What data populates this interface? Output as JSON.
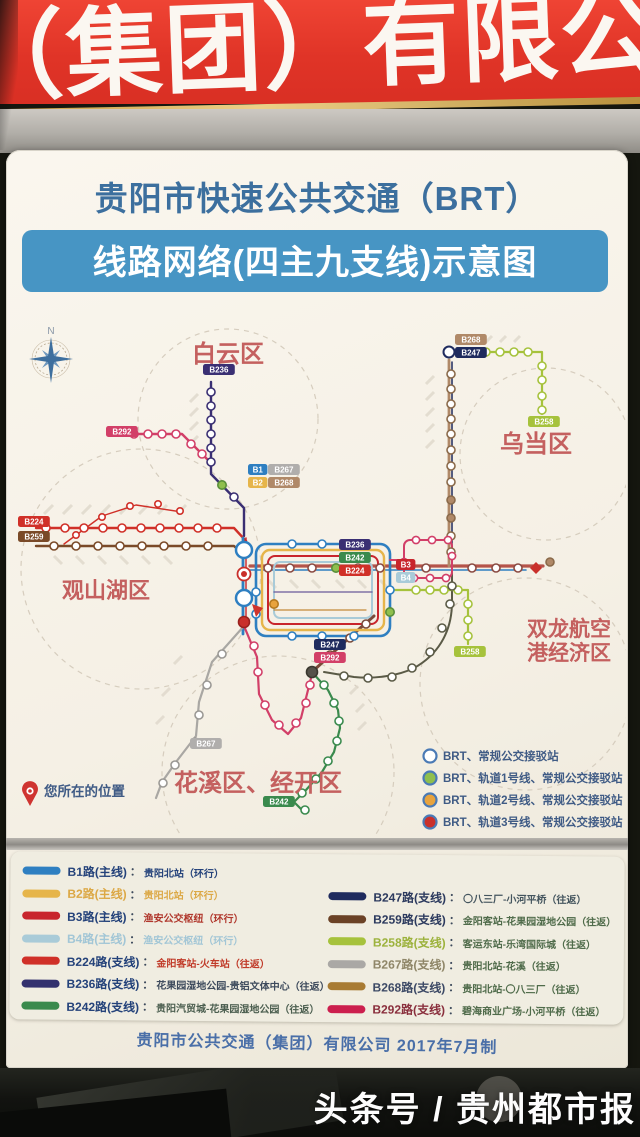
{
  "photo": {
    "top_banner_text": "（集团）有限公司",
    "watermark_text": "头条号 / 贵州都市报"
  },
  "poster": {
    "title": "贵阳市快速公共交通（BRT）",
    "subtitle": "线路网络(四主九支线)示意图",
    "footer": "贵阳市公共交通（集团）有限公司  2017年7月制",
    "colors": {
      "banner_red": "#e03427",
      "title_blue": "#3c6f9e",
      "subtitle_bg": "#4795c4",
      "poster_bg": "#f5f0e5",
      "region_label_red": "#c4605f"
    }
  },
  "map": {
    "compass_label": "N",
    "location_note": "您所在的位置",
    "region_labels": [
      {
        "text": "白云区",
        "x": 222,
        "y": 58,
        "size": 24
      },
      {
        "text": "乌当区",
        "x": 530,
        "y": 148,
        "size": 24
      },
      {
        "text": "观山湖区",
        "x": 100,
        "y": 294,
        "size": 22
      },
      {
        "text": "双龙航空",
        "x": 563,
        "y": 332,
        "size": 21
      },
      {
        "text": "港经济区",
        "x": 563,
        "y": 356,
        "size": 21
      },
      {
        "text": "花溪区、经开区",
        "x": 252,
        "y": 487,
        "size": 24
      }
    ],
    "route_badges": [
      {
        "text": "B236",
        "x": 197,
        "y": 60,
        "color": "#3a2f73"
      },
      {
        "text": "B292",
        "x": 100,
        "y": 122,
        "color": "#d23f68"
      },
      {
        "text": "B224",
        "x": 12,
        "y": 212,
        "color": "#d03028"
      },
      {
        "text": "B259",
        "x": 12,
        "y": 227,
        "color": "#7a4a28"
      },
      {
        "text": "B268",
        "x": 449,
        "y": 30,
        "color": "#b08968"
      },
      {
        "text": "B247",
        "x": 449,
        "y": 43,
        "color": "#1f2b5e"
      },
      {
        "text": "B258",
        "x": 522,
        "y": 112,
        "color": "#a6c23c"
      },
      {
        "text": "B1",
        "x": 242,
        "y": 160,
        "color": "#2e7fc1"
      },
      {
        "text": "B267",
        "x": 262,
        "y": 160,
        "color": "#b0aeac"
      },
      {
        "text": "B2",
        "x": 242,
        "y": 173,
        "color": "#e6b54a"
      },
      {
        "text": "B268",
        "x": 262,
        "y": 173,
        "color": "#b08968"
      },
      {
        "text": "B236",
        "x": 333,
        "y": 235,
        "color": "#3a2f73"
      },
      {
        "text": "B242",
        "x": 333,
        "y": 248,
        "color": "#3a8a4d"
      },
      {
        "text": "B224",
        "x": 333,
        "y": 261,
        "color": "#d03028"
      },
      {
        "text": "B3",
        "x": 390,
        "y": 255,
        "color": "#c8252c"
      },
      {
        "text": "B4",
        "x": 390,
        "y": 268,
        "color": "#a9cbd8"
      },
      {
        "text": "B247",
        "x": 308,
        "y": 335,
        "color": "#1f2b5e"
      },
      {
        "text": "B292",
        "x": 308,
        "y": 348,
        "color": "#d23f68"
      },
      {
        "text": "B267",
        "x": 184,
        "y": 434,
        "color": "#b0aeac"
      },
      {
        "text": "B258",
        "x": 448,
        "y": 342,
        "color": "#a6c23c"
      },
      {
        "text": "B242",
        "x": 257,
        "y": 492,
        "color": "#3a8a4d"
      }
    ],
    "station_legend": [
      {
        "label": "BRT、常规公交接驳站",
        "fill": "#ffffff"
      },
      {
        "label": "BRT、轨道1号线、常规公交接驳站",
        "fill": "#8fbf4d"
      },
      {
        "label": "BRT、轨道2号线、常规公交接驳站",
        "fill": "#e8a33d"
      },
      {
        "label": "BRT、轨道3号线、常规公交接驳站",
        "fill": "#c9302b"
      }
    ]
  },
  "legend": {
    "separator": "：",
    "left": [
      {
        "name": "B1路(主线)",
        "desc": "贵阳北站（环行）",
        "swatch": "#2e7fc1",
        "name_color": "#24427a",
        "desc_color": "#24427a"
      },
      {
        "name": "B2路(主线)",
        "desc": "贵阳北站（环行）",
        "swatch": "#e6b54a",
        "name_color": "#dca845",
        "desc_color": "#dca845"
      },
      {
        "name": "B3路(主线)",
        "desc": "渔安公交枢纽（环行）",
        "swatch": "#c8252c",
        "name_color": "#24427a",
        "desc_color": "#b0372c"
      },
      {
        "name": "B4路(主线)",
        "desc": "渔安公交枢纽（环行）",
        "swatch": "#a9cbd8",
        "name_color": "#a2c6d6",
        "desc_color": "#a2c6d6"
      },
      {
        "name": "B224路(支线)",
        "desc": "金阳客站-火车站（往返）",
        "swatch": "#d03028",
        "name_color": "#24427a",
        "desc_color": "#c03a28"
      },
      {
        "name": "B236路(支线)",
        "desc": "花果园湿地公园-贵铝文体中心（往返）",
        "swatch": "#33316e",
        "name_color": "#24427a",
        "desc_color": "#3d4a5c"
      },
      {
        "name": "B242路(支线)",
        "desc": "贵阳汽贸城-花果园湿地公园（往返）",
        "swatch": "#3a8a4d",
        "name_color": "#24427a",
        "desc_color": "#4c5f50"
      }
    ],
    "right": [
      {
        "name": "B247路(支线)",
        "desc": "〇八三厂-小河平桥（往返）",
        "swatch": "#1f2b5e",
        "name_color": "#2c3a5e",
        "desc_color": "#44555e"
      },
      {
        "name": "B259路(支线)",
        "desc": "金阳客站-花果园湿地公园（往返）",
        "swatch": "#6b4226",
        "name_color": "#2c3a5e",
        "desc_color": "#4f6b4a"
      },
      {
        "name": "B258路(支线)",
        "desc": "客运东站-乐湾国际城（往返）",
        "swatch": "#a6c23c",
        "name_color": "#9cb23c",
        "desc_color": "#4f6b4a"
      },
      {
        "name": "B267路(支线)",
        "desc": "贵阳北站-花溪（往返）",
        "swatch": "#aaa8a5",
        "name_color": "#8f8668",
        "desc_color": "#4f6b4a"
      },
      {
        "name": "B268路(支线)",
        "desc": "贵阳北站-〇八三厂（往返）",
        "swatch": "#a87b33",
        "name_color": "#3d4a66",
        "desc_color": "#4f6b4a"
      },
      {
        "name": "B292路(支线)",
        "desc": "碧海商业广场-小河平桥（往返）",
        "swatch": "#cc1f4e",
        "name_color": "#8a2f3d",
        "desc_color": "#4f6b4a"
      }
    ]
  }
}
